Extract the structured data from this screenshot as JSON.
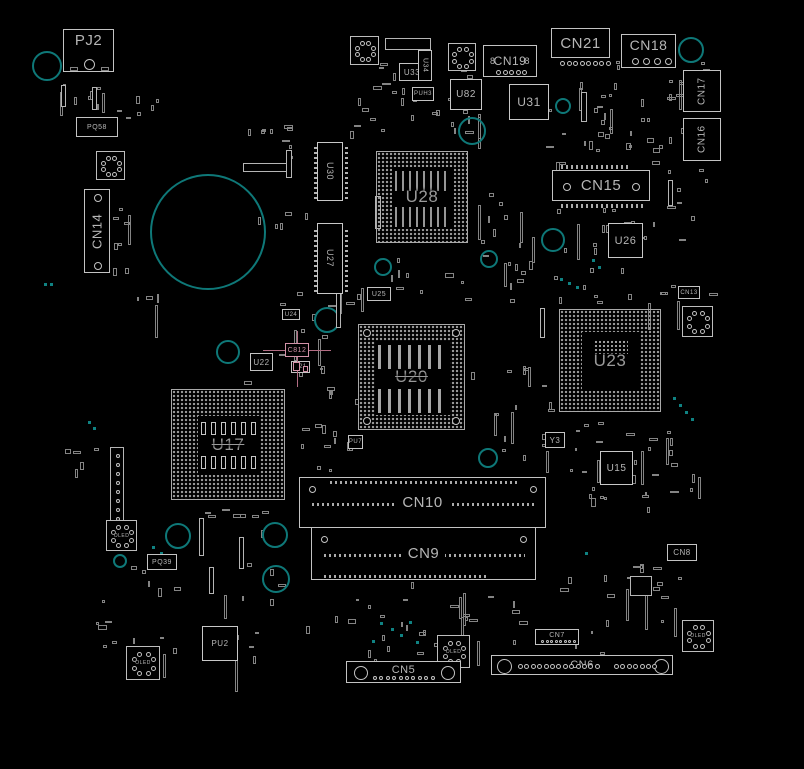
{
  "colors": {
    "bg": "#000000",
    "stroke": "#c8c8c8",
    "dim": "#8a8a8a",
    "teal": "#0e7878",
    "highlight": "#d392a8"
  },
  "bgas": [
    {
      "ref": "U28",
      "x": 376,
      "y": 151,
      "w": 92,
      "h": 92,
      "fs": 17,
      "style": "stripes"
    },
    {
      "ref": "U20",
      "x": 358,
      "y": 324,
      "w": 107,
      "h": 106,
      "fs": 17,
      "style": "stripes2",
      "strike": true
    },
    {
      "ref": "U23",
      "x": 559,
      "y": 309,
      "w": 102,
      "h": 103,
      "fs": 17,
      "style": "inner"
    },
    {
      "ref": "U17",
      "x": 171,
      "y": 389,
      "w": 114,
      "h": 111,
      "fs": 17,
      "style": "caps",
      "strike": true
    }
  ],
  "chips": [
    {
      "ref": "U31",
      "x": 509,
      "y": 84,
      "w": 40,
      "h": 36,
      "fs": 12
    },
    {
      "ref": "U82",
      "x": 450,
      "y": 79,
      "w": 32,
      "h": 31,
      "fs": 10
    },
    {
      "ref": "U26",
      "x": 608,
      "y": 223,
      "w": 35,
      "h": 35,
      "fs": 11
    },
    {
      "ref": "U15",
      "x": 600,
      "y": 451,
      "w": 33,
      "h": 34,
      "fs": 10
    },
    {
      "ref": "PU2",
      "x": 202,
      "y": 626,
      "w": 36,
      "h": 35,
      "fs": 8
    },
    {
      "ref": "U30",
      "x": 317,
      "y": 142,
      "w": 26,
      "h": 59,
      "fs": 9,
      "vert": true,
      "pins": true
    },
    {
      "ref": "U27",
      "x": 317,
      "y": 223,
      "w": 26,
      "h": 71,
      "fs": 9,
      "vert": true,
      "pins": true
    }
  ],
  "small_labels": [
    {
      "ref": "PQ58",
      "x": 76,
      "y": 117,
      "w": 42,
      "h": 20,
      "fs": 7
    },
    {
      "ref": "U33",
      "x": 399,
      "y": 63,
      "w": 26,
      "h": 18,
      "fs": 8
    },
    {
      "ref": "U34",
      "x": 418,
      "y": 50,
      "w": 14,
      "h": 31,
      "fs": 7,
      "vert": true
    },
    {
      "ref": "PUH3",
      "x": 412,
      "y": 87,
      "w": 22,
      "h": 14,
      "fs": 6
    },
    {
      "ref": "U25",
      "x": 367,
      "y": 287,
      "w": 24,
      "h": 14,
      "fs": 7
    },
    {
      "ref": "U24",
      "x": 282,
      "y": 309,
      "w": 18,
      "h": 11,
      "fs": 6
    },
    {
      "ref": "U22",
      "x": 250,
      "y": 353,
      "w": 23,
      "h": 18,
      "fs": 8
    },
    {
      "ref": "U21",
      "x": 291,
      "y": 361,
      "w": 19,
      "h": 12,
      "fs": 6
    },
    {
      "ref": "PU7",
      "x": 348,
      "y": 435,
      "w": 15,
      "h": 14,
      "fs": 6
    },
    {
      "ref": "PQ39",
      "x": 147,
      "y": 554,
      "w": 30,
      "h": 16,
      "fs": 7
    },
    {
      "ref": "Y3",
      "x": 545,
      "y": 432,
      "w": 20,
      "h": 16,
      "fs": 8
    },
    {
      "ref": "CN13",
      "x": 678,
      "y": 286,
      "w": 22,
      "h": 13,
      "fs": 6
    },
    {
      "ref": "CN8",
      "x": 667,
      "y": 544,
      "w": 30,
      "h": 17,
      "fs": 8
    }
  ],
  "highlight": {
    "ref": "C812",
    "x": 285,
    "y": 343,
    "w": 24,
    "h": 14,
    "fs": 7
  },
  "connectors": [
    {
      "ref": "PJ2",
      "kind": "pj",
      "x": 63,
      "y": 29,
      "w": 51,
      "h": 43,
      "fs": 15
    },
    {
      "ref": "CN14",
      "kind": "vconn",
      "x": 84,
      "y": 189,
      "w": 26,
      "h": 84,
      "fs": 13
    },
    {
      "ref": "CN21",
      "kind": "dotsbelow",
      "x": 551,
      "y": 28,
      "w": 59,
      "h": 30,
      "fs": 15,
      "dots": 8
    },
    {
      "ref": "CN18",
      "kind": "circbottom",
      "x": 621,
      "y": 34,
      "w": 55,
      "h": 34,
      "fs": 14,
      "dots": 4
    },
    {
      "ref": "CN17",
      "kind": "vbox",
      "x": 683,
      "y": 70,
      "w": 38,
      "h": 42,
      "fs": 10
    },
    {
      "ref": "CN16",
      "kind": "vbox",
      "x": 683,
      "y": 118,
      "w": 38,
      "h": 43,
      "fs": 10
    },
    {
      "ref": "CN19",
      "kind": "cn19",
      "x": 483,
      "y": 45,
      "w": 54,
      "h": 32,
      "fs": 12,
      "side": "8",
      "dots": 5
    },
    {
      "ref": "CN15",
      "kind": "header",
      "x": 552,
      "y": 170,
      "w": 98,
      "h": 31,
      "fs": 15
    },
    {
      "ref": "CN10",
      "kind": "dimm",
      "x": 299,
      "y": 477,
      "w": 247,
      "h": 51,
      "fs": 15,
      "ticks": "top"
    },
    {
      "ref": "CN9",
      "kind": "dimm",
      "x": 311,
      "y": 527,
      "w": 225,
      "h": 53,
      "fs": 15,
      "ticks": "bottom"
    },
    {
      "ref": "CN5",
      "kind": "edge",
      "x": 346,
      "y": 661,
      "w": 115,
      "h": 22,
      "fs": 11,
      "dots": 10
    },
    {
      "ref": "CN6",
      "kind": "edge6",
      "x": 491,
      "y": 655,
      "w": 182,
      "h": 20,
      "fs": 11
    },
    {
      "ref": "CN7",
      "kind": "minidots",
      "x": 535,
      "y": 629,
      "w": 44,
      "h": 16,
      "fs": 7,
      "dots": 8
    }
  ],
  "coils": [
    {
      "x": 96,
      "y": 151,
      "s": 29
    },
    {
      "x": 350,
      "y": 36,
      "s": 29
    },
    {
      "x": 448,
      "y": 43,
      "s": 28
    },
    {
      "x": 682,
      "y": 306,
      "s": 31
    },
    {
      "x": 106,
      "y": 520,
      "s": 31,
      "label": "OLED"
    },
    {
      "x": 126,
      "y": 646,
      "s": 34,
      "label": "OLED"
    },
    {
      "x": 437,
      "y": 635,
      "s": 33,
      "label": "OLED"
    },
    {
      "x": 682,
      "y": 620,
      "s": 32,
      "label": "OLED"
    }
  ],
  "teal_circles": [
    [
      47,
      66,
      15
    ],
    [
      208,
      232,
      58
    ],
    [
      472,
      131,
      14
    ],
    [
      383,
      267,
      9
    ],
    [
      489,
      259,
      9
    ],
    [
      553,
      240,
      12
    ],
    [
      327,
      320,
      13
    ],
    [
      228,
      352,
      12
    ],
    [
      488,
      458,
      10
    ],
    [
      563,
      106,
      8
    ],
    [
      691,
      50,
      13
    ],
    [
      178,
      536,
      13
    ],
    [
      275,
      535,
      13
    ],
    [
      276,
      579,
      14
    ],
    [
      120,
      561,
      7
    ],
    [
      526,
      494,
      12
    ]
  ],
  "teal_dots": [
    [
      673,
      397
    ],
    [
      679,
      404
    ],
    [
      685,
      411
    ],
    [
      691,
      418
    ],
    [
      560,
      278
    ],
    [
      568,
      282
    ],
    [
      576,
      286
    ],
    [
      88,
      421
    ],
    [
      93,
      427
    ],
    [
      380,
      622
    ],
    [
      391,
      628
    ],
    [
      400,
      634
    ],
    [
      409,
      621
    ],
    [
      372,
      640
    ],
    [
      416,
      641
    ],
    [
      585,
      552
    ],
    [
      152,
      546
    ],
    [
      160,
      552
    ],
    [
      44,
      283
    ],
    [
      50,
      283
    ],
    [
      592,
      259
    ],
    [
      598,
      266
    ]
  ],
  "slots": [
    {
      "x": 110,
      "y": 447,
      "w": 14,
      "h": 86,
      "dots": true
    },
    {
      "x": 61,
      "y": 85,
      "w": 5,
      "h": 22
    },
    {
      "x": 92,
      "y": 87,
      "w": 5,
      "h": 23
    },
    {
      "x": 199,
      "y": 518,
      "w": 5,
      "h": 38
    },
    {
      "x": 239,
      "y": 537,
      "w": 5,
      "h": 32
    },
    {
      "x": 209,
      "y": 567,
      "w": 5,
      "h": 27
    },
    {
      "x": 336,
      "y": 292,
      "w": 5,
      "h": 36
    },
    {
      "x": 375,
      "y": 196,
      "w": 6,
      "h": 33
    },
    {
      "x": 286,
      "y": 150,
      "w": 6,
      "h": 28
    },
    {
      "x": 581,
      "y": 92,
      "w": 6,
      "h": 30
    },
    {
      "x": 668,
      "y": 180,
      "w": 5,
      "h": 26
    },
    {
      "x": 540,
      "y": 308,
      "w": 5,
      "h": 30
    },
    {
      "x": 630,
      "y": 576,
      "w": 22,
      "h": 20
    },
    {
      "x": 385,
      "y": 38,
      "w": 46,
      "h": 12
    },
    {
      "x": 243,
      "y": 163,
      "w": 44,
      "h": 9
    }
  ],
  "noise_clusters": [
    [
      60,
      78,
      50,
      30,
      8
    ],
    [
      116,
      92,
      40,
      28,
      6
    ],
    [
      245,
      118,
      45,
      45,
      9
    ],
    [
      340,
      62,
      130,
      75,
      26
    ],
    [
      462,
      96,
      22,
      55,
      5
    ],
    [
      545,
      58,
      140,
      105,
      30
    ],
    [
      600,
      95,
      80,
      55,
      10
    ],
    [
      655,
      168,
      55,
      130,
      10
    ],
    [
      470,
      188,
      70,
      75,
      12
    ],
    [
      332,
      258,
      135,
      50,
      16
    ],
    [
      548,
      202,
      105,
      95,
      20
    ],
    [
      558,
      282,
      120,
      25,
      8
    ],
    [
      242,
      292,
      115,
      105,
      14
    ],
    [
      300,
      382,
      55,
      75,
      8
    ],
    [
      470,
      332,
      85,
      125,
      16
    ],
    [
      540,
      422,
      115,
      85,
      24
    ],
    [
      640,
      430,
      60,
      70,
      10
    ],
    [
      556,
      556,
      125,
      100,
      22
    ],
    [
      96,
      562,
      200,
      95,
      26
    ],
    [
      300,
      582,
      165,
      75,
      20
    ],
    [
      128,
      288,
      35,
      18,
      4
    ],
    [
      190,
      508,
      105,
      25,
      8
    ],
    [
      302,
      642,
      160,
      25,
      10
    ],
    [
      60,
      440,
      45,
      35,
      5
    ],
    [
      480,
      252,
      55,
      55,
      7
    ],
    [
      245,
      205,
      60,
      20,
      5
    ],
    [
      663,
      62,
      45,
      45,
      6
    ],
    [
      112,
      205,
      16,
      70,
      8
    ],
    [
      300,
      420,
      52,
      60,
      6
    ],
    [
      440,
      585,
      90,
      60,
      8
    ]
  ]
}
